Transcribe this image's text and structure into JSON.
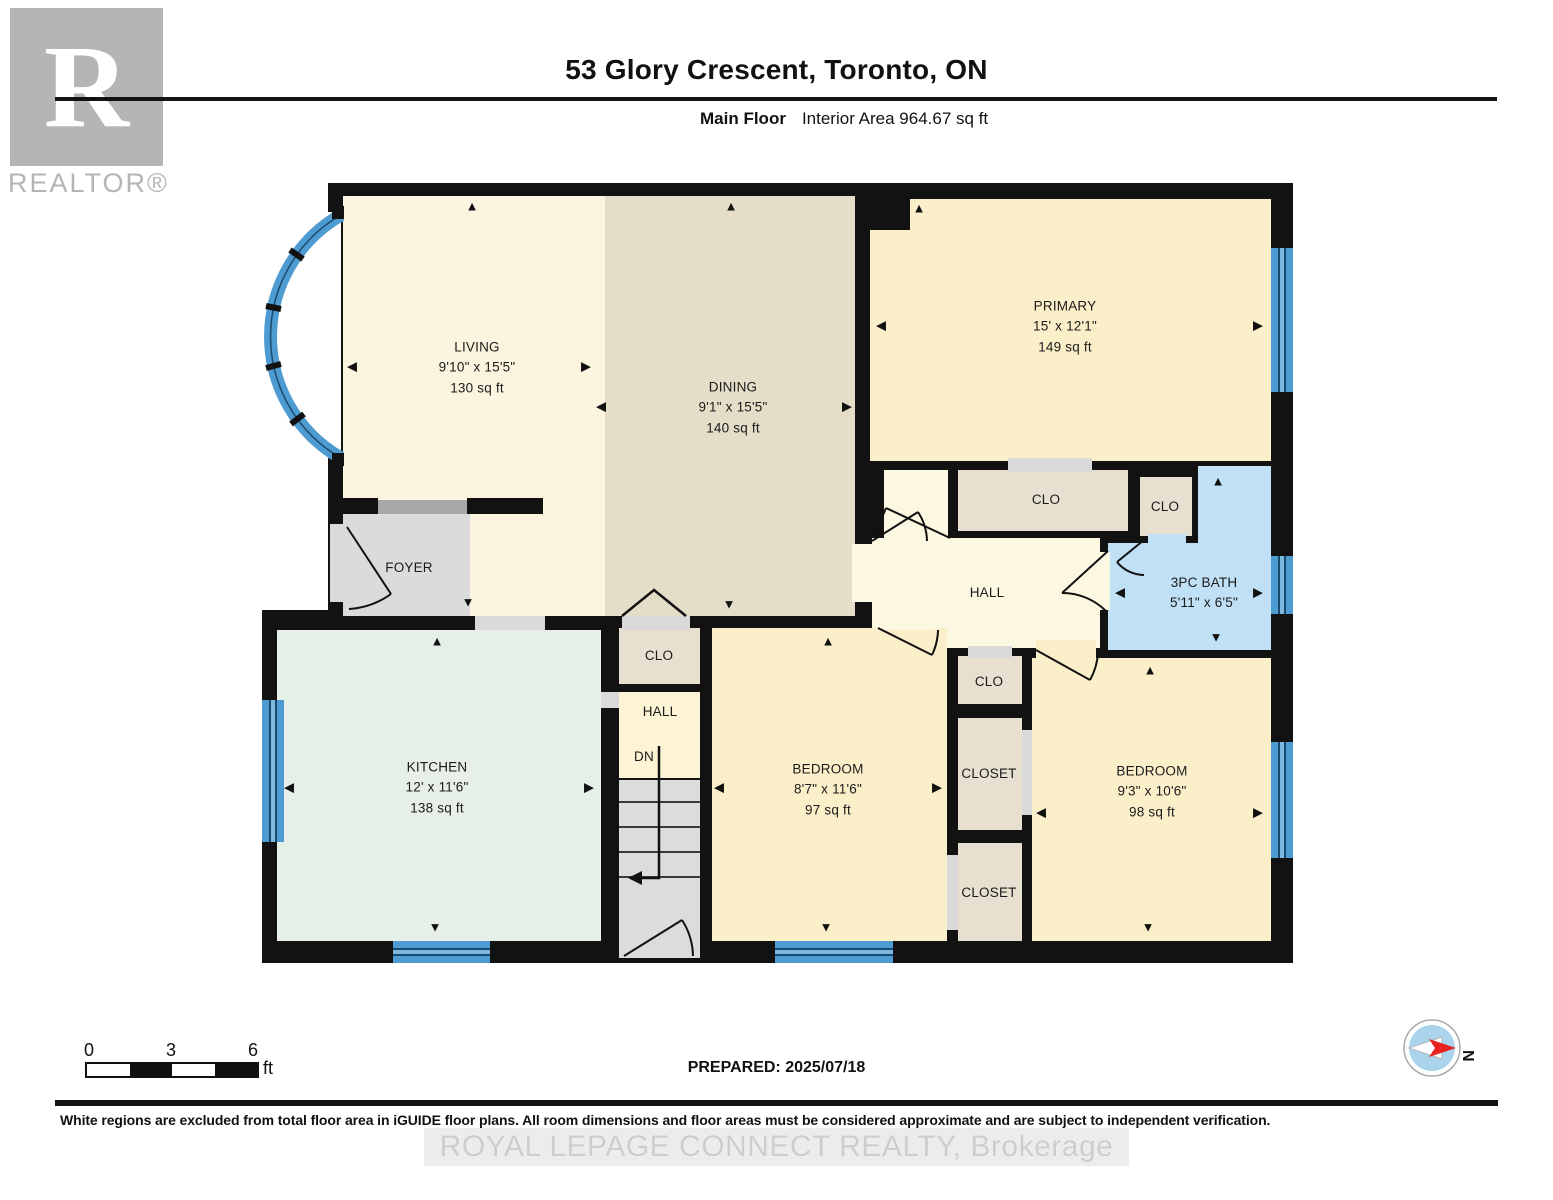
{
  "header": {
    "title": "53 Glory Crescent, Toronto, ON",
    "floor_label": "Main Floor",
    "area_label": "Interior Area 964.67 sq ft"
  },
  "logo": {
    "letter": "R",
    "name": "REALTOR®"
  },
  "rooms": {
    "living": {
      "name": "LIVING",
      "dims": "9'10\" x 15'5\"",
      "area": "130 sq ft"
    },
    "dining": {
      "name": "DINING",
      "dims": "9'1\" x 15'5\"",
      "area": "140 sq ft"
    },
    "primary": {
      "name": "PRIMARY",
      "dims": "15' x 12'1\"",
      "area": "149 sq ft"
    },
    "bath": {
      "name": "3PC BATH",
      "dims": "5'11\" x 6'5\""
    },
    "kitchen": {
      "name": "KITCHEN",
      "dims": "12' x 11'6\"",
      "area": "138 sq ft"
    },
    "bedroom1": {
      "name": "BEDROOM",
      "dims": "8'7\" x 11'6\"",
      "area": "97 sq ft"
    },
    "bedroom2": {
      "name": "BEDROOM",
      "dims": "9'3\" x 10'6\"",
      "area": "98 sq ft"
    },
    "foyer": {
      "name": "FOYER"
    }
  },
  "labels": {
    "clo": "CLO",
    "closet": "CLOSET",
    "hall": "HALL",
    "dn": "DN"
  },
  "icons": {
    "arrow_up": "▲",
    "arrow_down": "▼",
    "arrow_left": "◀",
    "arrow_right": "▶"
  },
  "scale_bar": {
    "ticks": [
      "0",
      "3",
      "6"
    ],
    "unit": "ft"
  },
  "compass": {
    "north_label": "N"
  },
  "footer": {
    "prepared": "PREPARED: 2025/07/18",
    "disclaimer": "White regions are excluded from total floor area in iGUIDE floor plans. All room dimensions and floor areas must be considered approximate and are subject to independent verification.",
    "watermark": "ROYAL LEPAGE CONNECT REALTY, Brokerage"
  },
  "colors": {
    "wall": "#121212",
    "living": "#fbf4df",
    "dining": "#e4ddc8",
    "bedroom": "#fbefca",
    "kitchen": "#e7efe9",
    "bath": "#bfe0f5",
    "hall": "#fcf7e1",
    "closet": "#e7e0d1",
    "foyer": "#dbdbdb",
    "window": "#4d9bd1",
    "compass_red": "#e8221c"
  }
}
